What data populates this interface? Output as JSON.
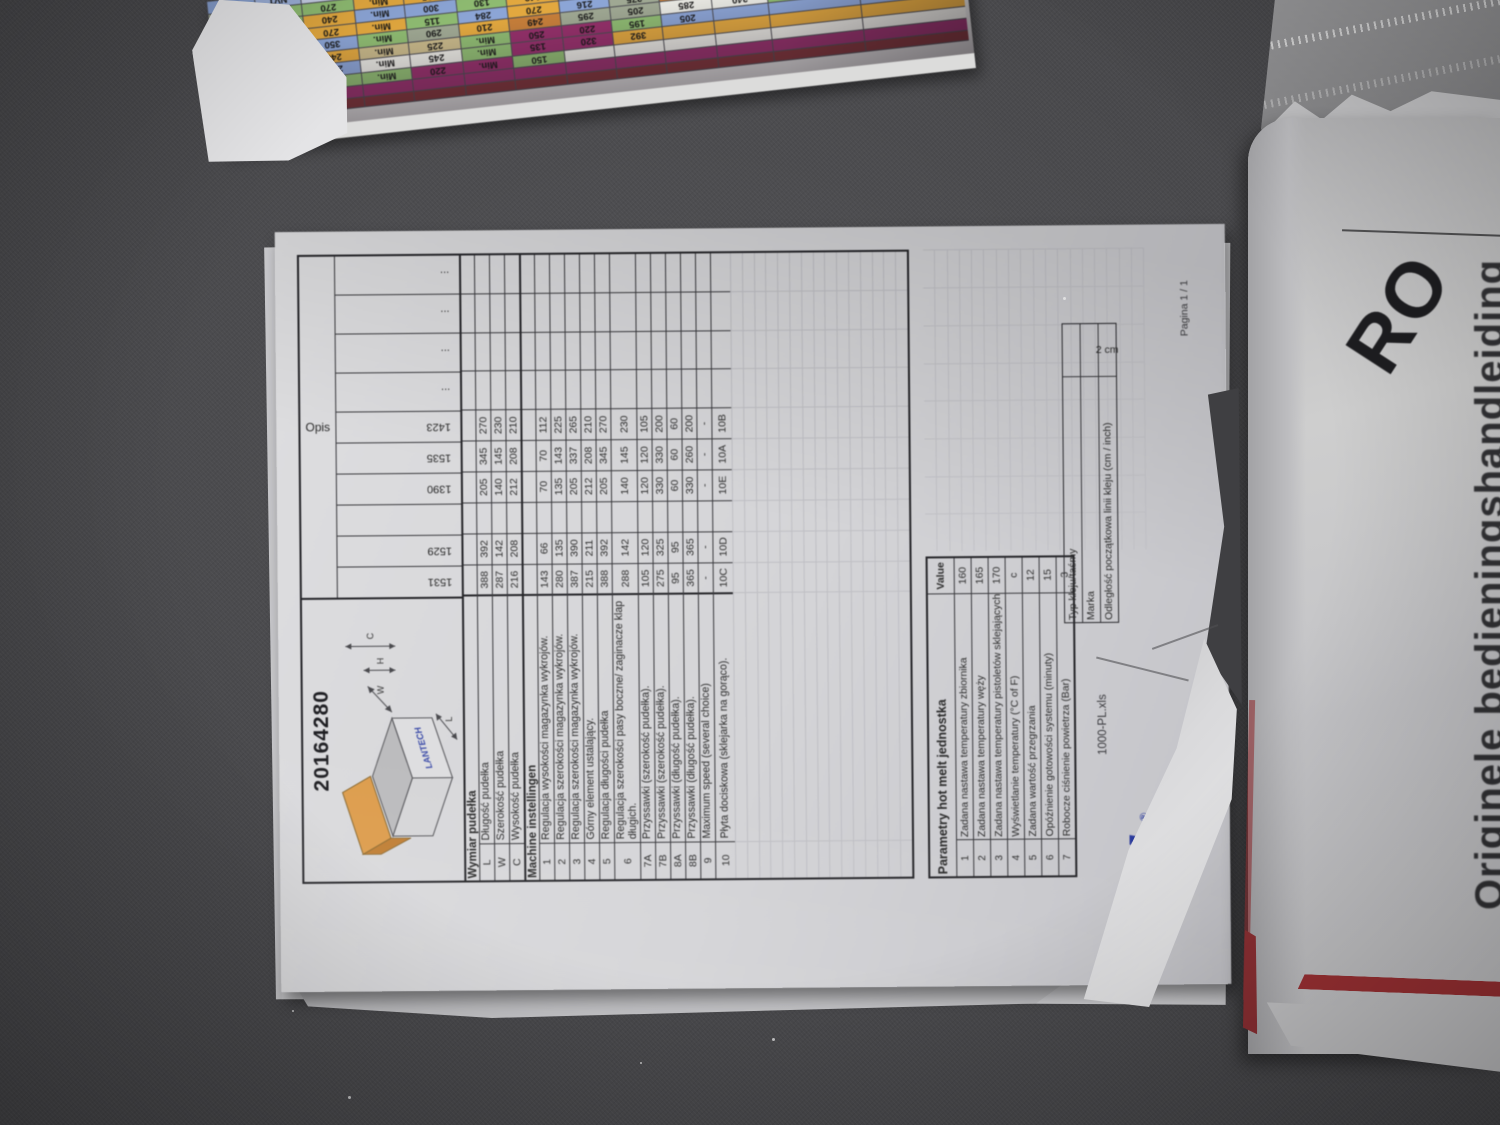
{
  "main_document": {
    "title": "20164280",
    "diagram": {
      "brand": "LANTECH",
      "dim_labels": [
        "C",
        "H",
        "W",
        "L"
      ]
    },
    "table": {
      "opis_label": "Opis",
      "col_headers": [
        "1531",
        "1529",
        "",
        "1390",
        "1535",
        "1423",
        "...",
        "...",
        "...",
        "..."
      ],
      "sections": [
        {
          "header": "Wymiar pudełka",
          "rows": [
            {
              "idx": "L",
              "label": "Długość pudełka",
              "values": [
                "388",
                "392",
                "",
                "205",
                "345",
                "270"
              ]
            },
            {
              "idx": "W",
              "label": "Szerokość pudełka",
              "values": [
                "287",
                "142",
                "",
                "140",
                "145",
                "230"
              ]
            },
            {
              "idx": "C",
              "label": "Wysokość pudełka",
              "values": [
                "216",
                "208",
                "",
                "212",
                "208",
                "210"
              ]
            }
          ]
        },
        {
          "header": "Machine instellingen",
          "rows": [
            {
              "idx": "1",
              "label": "Regulacja wysokości magazynka wykrojów.",
              "values": [
                "143",
                "66",
                "",
                "70",
                "70",
                "112"
              ]
            },
            {
              "idx": "2",
              "label": "Regulacja szerokości magazynka wykrojów.",
              "values": [
                "280",
                "135",
                "",
                "135",
                "143",
                "225"
              ]
            },
            {
              "idx": "3",
              "label": "Regulacja szerokości magazynka wykrojów.",
              "values": [
                "387",
                "390",
                "",
                "205",
                "337",
                "265"
              ]
            },
            {
              "idx": "4",
              "label": "Górny element ustalający.",
              "values": [
                "215",
                "211",
                "",
                "212",
                "208",
                "210"
              ]
            },
            {
              "idx": "5",
              "label": "Regulacja długości pudełka",
              "values": [
                "388",
                "392",
                "",
                "205",
                "345",
                "270"
              ]
            },
            {
              "idx": "6",
              "label": "Regulacja szerokości pasy boczne/ zaginacze klap długich.",
              "values": [
                "288",
                "142",
                "",
                "140",
                "145",
                "230"
              ],
              "tall": true
            },
            {
              "idx": "7A",
              "label": "Przyssawki (szerokość pudełka).",
              "values": [
                "105",
                "120",
                "",
                "120",
                "120",
                "105"
              ]
            },
            {
              "idx": "7B",
              "label": "Przyssawki (szerokość pudełka).",
              "values": [
                "275",
                "325",
                "",
                "330",
                "330",
                "200"
              ]
            },
            {
              "idx": "8A",
              "label": "Przyssawki (długość pudełka).",
              "values": [
                "95",
                "95",
                "",
                "60",
                "60",
                "60"
              ]
            },
            {
              "idx": "8B",
              "label": "Przyssawki (długość pudełka).",
              "values": [
                "365",
                "365",
                "",
                "330",
                "260",
                "200"
              ]
            },
            {
              "idx": "9",
              "label": "Maximum speed (several choice)",
              "values": [
                "-",
                "-",
                "",
                "-",
                "-",
                "-"
              ]
            },
            {
              "idx": "10",
              "label": "Płyta dociskowa (sklejarka na  gorąco).",
              "values": [
                "10C",
                "10D",
                "",
                "10E",
                "10A",
                "10B"
              ],
              "tall2": true
            }
          ]
        }
      ]
    },
    "parametry": {
      "header": "Parametry hot melt jednostka",
      "value_header": "Value",
      "rows": [
        {
          "idx": "1",
          "label": "Zadana nastawa temperatury zbiornika",
          "value": "160"
        },
        {
          "idx": "2",
          "label": "Zadana nastawa temperatury węży",
          "value": "165"
        },
        {
          "idx": "3",
          "label": "Zadana nastawa temperatury pistoletów sklejających",
          "value": "170"
        },
        {
          "idx": "4",
          "label": "Wyświetlanie temperatury (°C of F)",
          "value": "c"
        },
        {
          "idx": "5",
          "label": "Zadana wartość przegrzania",
          "value": "12"
        },
        {
          "idx": "6",
          "label": "Opóźnienie gotowości systemu (minuty)",
          "value": "15"
        },
        {
          "idx": "7",
          "label": "Robocze ciśnienie powietrza (Bar)",
          "value": "3"
        }
      ],
      "extra_rows": [
        {
          "label": "Typ kleju/taśmy",
          "value": ""
        },
        {
          "label": "Marka",
          "value": ""
        },
        {
          "label": "Odległość początkowa linii kleju (cm / inch)",
          "value": "2 cm"
        }
      ]
    },
    "footer": {
      "filename": "1000-PL.xls",
      "page": "Pagina 1 / 1",
      "logo_text": "tech",
      "logo_reg": "®"
    }
  },
  "color_sheet": {
    "rows": [
      {
        "base": "#8CA5D6",
        "cells": [
          [
            "10H",
            null
          ],
          [
            "NVT",
            "#9FB3DC"
          ],
          [
            "215",
            "#C9D2E8"
          ],
          [
            "Min.",
            "#E2A83F"
          ],
          [
            "300",
            "#E2A83F"
          ],
          [
            "130",
            "#8FBC72"
          ],
          [
            "210",
            "#E2A83F"
          ],
          [
            "345",
            "#8CA5D6"
          ],
          [
            "210",
            "#8CA5D6"
          ],
          [
            "387",
            "#8FBC72"
          ],
          [
            "280",
            "#8CA5D6"
          ],
          [
            "50032848",
            "#E2A83F"
          ],
          [
            "",
            null
          ]
        ]
      },
      {
        "base": "#9FA893",
        "cells": [
          [
            "10G",
            null
          ],
          [
            "NVT",
            "#8FBC72"
          ],
          [
            "270",
            "#8FBC72"
          ],
          [
            "Min.",
            "#E2A83F"
          ],
          [
            "225",
            "#E2A83F"
          ],
          [
            "Min.",
            "#C9CF8E"
          ],
          [
            "149",
            "#E2A83F"
          ],
          [
            "345",
            "#8CA5D6"
          ],
          [
            "210",
            "#8CA5D6"
          ],
          [
            "387",
            "#E2A83F"
          ],
          [
            "100",
            "#8CA5D6"
          ],
          [
            "50032845",
            "#8CA5D6"
          ],
          [
            "87X240x205",
            null
          ]
        ]
      },
      {
        "base": "#8FBC72",
        "cells": [
          [
            "10A",
            null
          ],
          [
            "NVT",
            null
          ],
          [
            "240",
            "#E2A83F"
          ],
          [
            "Min.",
            "#8CA5D6"
          ],
          [
            "300",
            "#8CA5D6"
          ],
          [
            "130",
            null
          ],
          [
            "149",
            "#E2A83F"
          ],
          [
            "388",
            "#8CA5D6"
          ],
          [
            "210",
            "#E2A83F"
          ],
          [
            "270",
            "#8FBC72"
          ],
          [
            "115",
            "#9FA893"
          ],
          [
            "50032815",
            "#9FA893"
          ],
          [
            "",
            null
          ]
        ]
      },
      {
        "base": "#E2A83F",
        "cells": [
          [
            "10B",
            null
          ],
          [
            "NVT",
            null
          ],
          [
            "270",
            null
          ],
          [
            "Min.",
            null
          ],
          [
            "115",
            "#8FBC72"
          ],
          [
            "284",
            "#8CA5D6"
          ],
          [
            "270",
            "#E2A83F"
          ],
          [
            "216",
            "#8CA5D6"
          ],
          [
            "275",
            "#9FA893"
          ],
          [
            "250",
            "#C77F3A"
          ],
          [
            "128",
            "#E9E9E3"
          ],
          [
            "50032830",
            "#E9E9E3"
          ],
          [
            "269X257X205",
            "#E9E9E3"
          ]
        ]
      },
      {
        "base": "#8FBC72",
        "cells": [
          [
            "10A",
            null
          ],
          [
            "NVT",
            "#8CA5D6"
          ],
          [
            "350",
            "#8CA5D6"
          ],
          [
            "Min.",
            null
          ],
          [
            "290",
            "#9FA893"
          ],
          [
            "210",
            "#E2A83F"
          ],
          [
            "249",
            "#C77F3A"
          ],
          [
            "295",
            "#9FA893"
          ],
          [
            "205",
            "#9FA893"
          ],
          [
            "285",
            "#E9E9E3"
          ],
          [
            "240",
            "#E9E9E3"
          ],
          [
            "",
            null
          ],
          [
            "",
            null
          ]
        ]
      },
      {
        "base": "#8CA5D6",
        "cells": [
          [
            "10C",
            null
          ],
          [
            "NVT",
            "#E2A83F"
          ],
          [
            "240",
            "#E2A83F"
          ],
          [
            "Min.",
            "#C8B98A"
          ],
          [
            "225",
            "#C8B98A"
          ],
          [
            "Min.",
            "#8FBC72"
          ],
          [
            "250",
            "#96306B"
          ],
          [
            "220",
            "#96306B"
          ],
          [
            "195",
            "#8FBC72"
          ],
          [
            "205",
            null
          ],
          [
            "",
            null
          ],
          [
            "",
            null
          ],
          [
            "",
            null
          ]
        ]
      },
      {
        "base": "#E2A83F",
        "cells": [
          [
            "10B",
            null
          ],
          [
            "NVT",
            null
          ],
          [
            "270",
            "#8CA5D6"
          ],
          [
            "Min.",
            "#E9E9E3"
          ],
          [
            "245",
            "#E9E9E3"
          ],
          [
            "Min.",
            "#8FBC72"
          ],
          [
            "135",
            "#96306B"
          ],
          [
            "320",
            "#96306B"
          ],
          [
            "392",
            null
          ],
          [
            "",
            null
          ],
          [
            "",
            null
          ],
          [
            "",
            null
          ],
          [
            "",
            null
          ]
        ]
      },
      {
        "base": "#E9E9E3",
        "cells": [
          [
            "10B",
            null
          ],
          [
            "NVT",
            null
          ],
          [
            "255",
            "#8FBC72"
          ],
          [
            "Min.",
            "#8FBC72"
          ],
          [
            "220",
            "#96306B"
          ],
          [
            "Min.",
            "#96306B"
          ],
          [
            "150",
            "#8FBC72"
          ],
          [
            "",
            null
          ],
          [
            "",
            null
          ],
          [
            "",
            null
          ],
          [
            "",
            null
          ],
          [
            "",
            null
          ],
          [
            "",
            null
          ]
        ]
      },
      {
        "base": "#96306B",
        "cells": [
          [
            "",
            null
          ],
          [
            "",
            null
          ],
          [
            "",
            null
          ],
          [
            "",
            null
          ],
          [
            "",
            null
          ],
          [
            "",
            null
          ],
          [
            "",
            null
          ],
          [
            "",
            null
          ],
          [
            "",
            null
          ],
          [
            "",
            null
          ],
          [
            "",
            null
          ],
          [
            "",
            null
          ],
          [
            "",
            null
          ]
        ],
        "h": 12
      },
      {
        "base": "#7E3338",
        "cells": [
          [
            "",
            null
          ],
          [
            "",
            null
          ],
          [
            "",
            null
          ],
          [
            "",
            null
          ],
          [
            "",
            null
          ],
          [
            "",
            null
          ],
          [
            "",
            null
          ],
          [
            "",
            null
          ],
          [
            "",
            null
          ],
          [
            "",
            null
          ],
          [
            "",
            null
          ],
          [
            "",
            null
          ],
          [
            "",
            null
          ]
        ],
        "h": 10
      }
    ]
  },
  "right_stack": {
    "ro_text": "RO",
    "side_text": "Originele bedieningshandleiding"
  },
  "colors": {
    "floor": "#48484b",
    "paper": "#d5d5d7",
    "logo_blue": "#2b3b9c",
    "stripe_red": "#9e3134",
    "box_flap_orange": "#dd9d4d"
  }
}
